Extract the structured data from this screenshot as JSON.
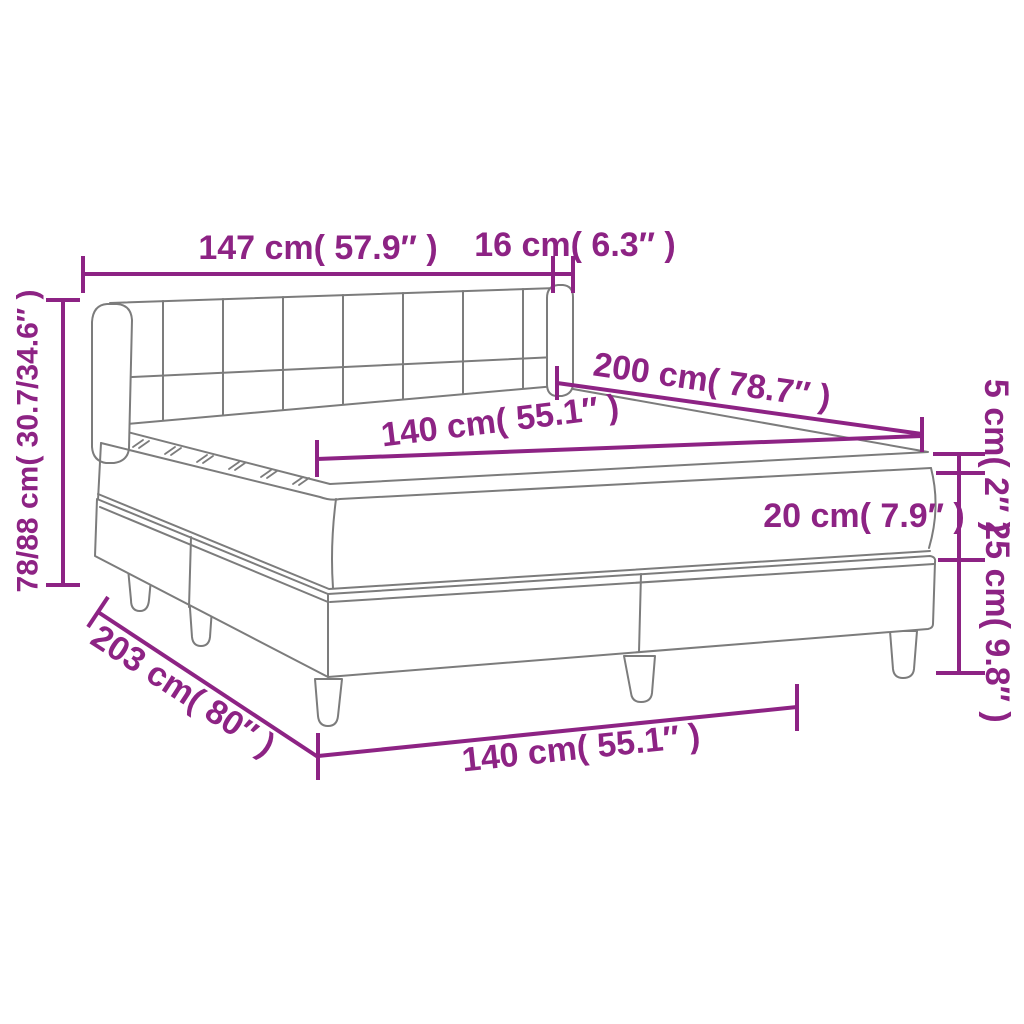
{
  "diagram": {
    "type": "product-dimension-diagram",
    "subject": "box spring bed with headboard, mattress and topper",
    "colors": {
      "dimension_accent": "#8D2384",
      "line_art": "#7C7C7C",
      "background": "#FFFFFF"
    }
  },
  "labels": {
    "headboard_width": "147 cm( 57.9″ )",
    "headboard_depth": "16 cm( 6.3″ )",
    "total_height": "78/88 cm( 30.7/34.6″ )",
    "bed_length": "200 cm( 78.7″ )",
    "mattress_width": "140 cm( 55.1″ )",
    "topper_height": "5 cm( 2″ )",
    "mattress_height": "20 cm( 7.9″ )",
    "base_height": "25 cm( 9.8″ )",
    "base_length": "203 cm( 80″ )",
    "base_width": "140 cm( 55.1″ )"
  }
}
